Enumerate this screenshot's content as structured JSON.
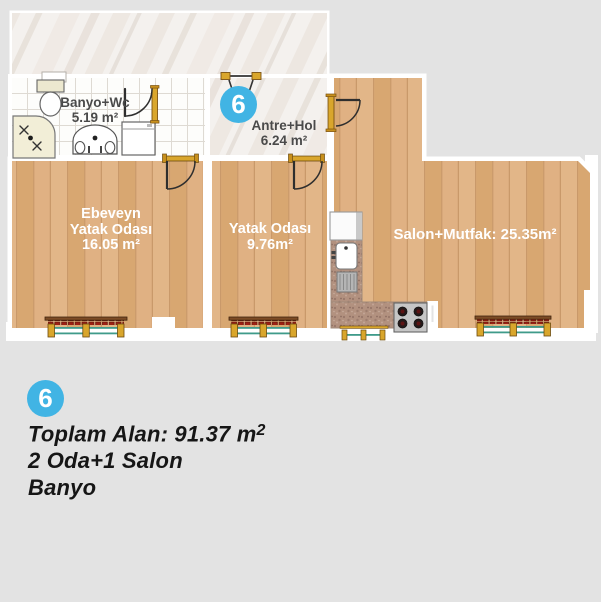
{
  "unit": {
    "number": "6"
  },
  "rooms": {
    "banyo": {
      "name": "Banyo+Wc",
      "area": "5.19 m²"
    },
    "antre": {
      "name": "Antre+Hol",
      "area": "6.24 m²"
    },
    "ebeveyn": {
      "name_line1": "Ebeveyn",
      "name_line2": "Yatak Odası",
      "area": "16.05 m²"
    },
    "yatak": {
      "name": "Yatak Odası",
      "area": "9.76m²"
    },
    "salon": {
      "label": "Salon+Mutfak: 25.35m²"
    }
  },
  "summary": {
    "total_area_prefix": "Toplam Alan: 91.37 m",
    "total_area_sup": "2",
    "line2": "2 Oda+1 Salon",
    "line3": "Banyo"
  },
  "palette": {
    "background": "#e3e3e3",
    "accent_blue": "#41b4e4",
    "wood": "#dcab79",
    "marble": "#f4f1ee",
    "counter": "#b2917f",
    "radiator_red": "#9c2014",
    "gold_trim": "#d9a62c",
    "teal_pipe": "#3f9b8a",
    "wall": "#ffffff",
    "label_dark": "#4a4a4a",
    "label_light": "#ffffff"
  }
}
